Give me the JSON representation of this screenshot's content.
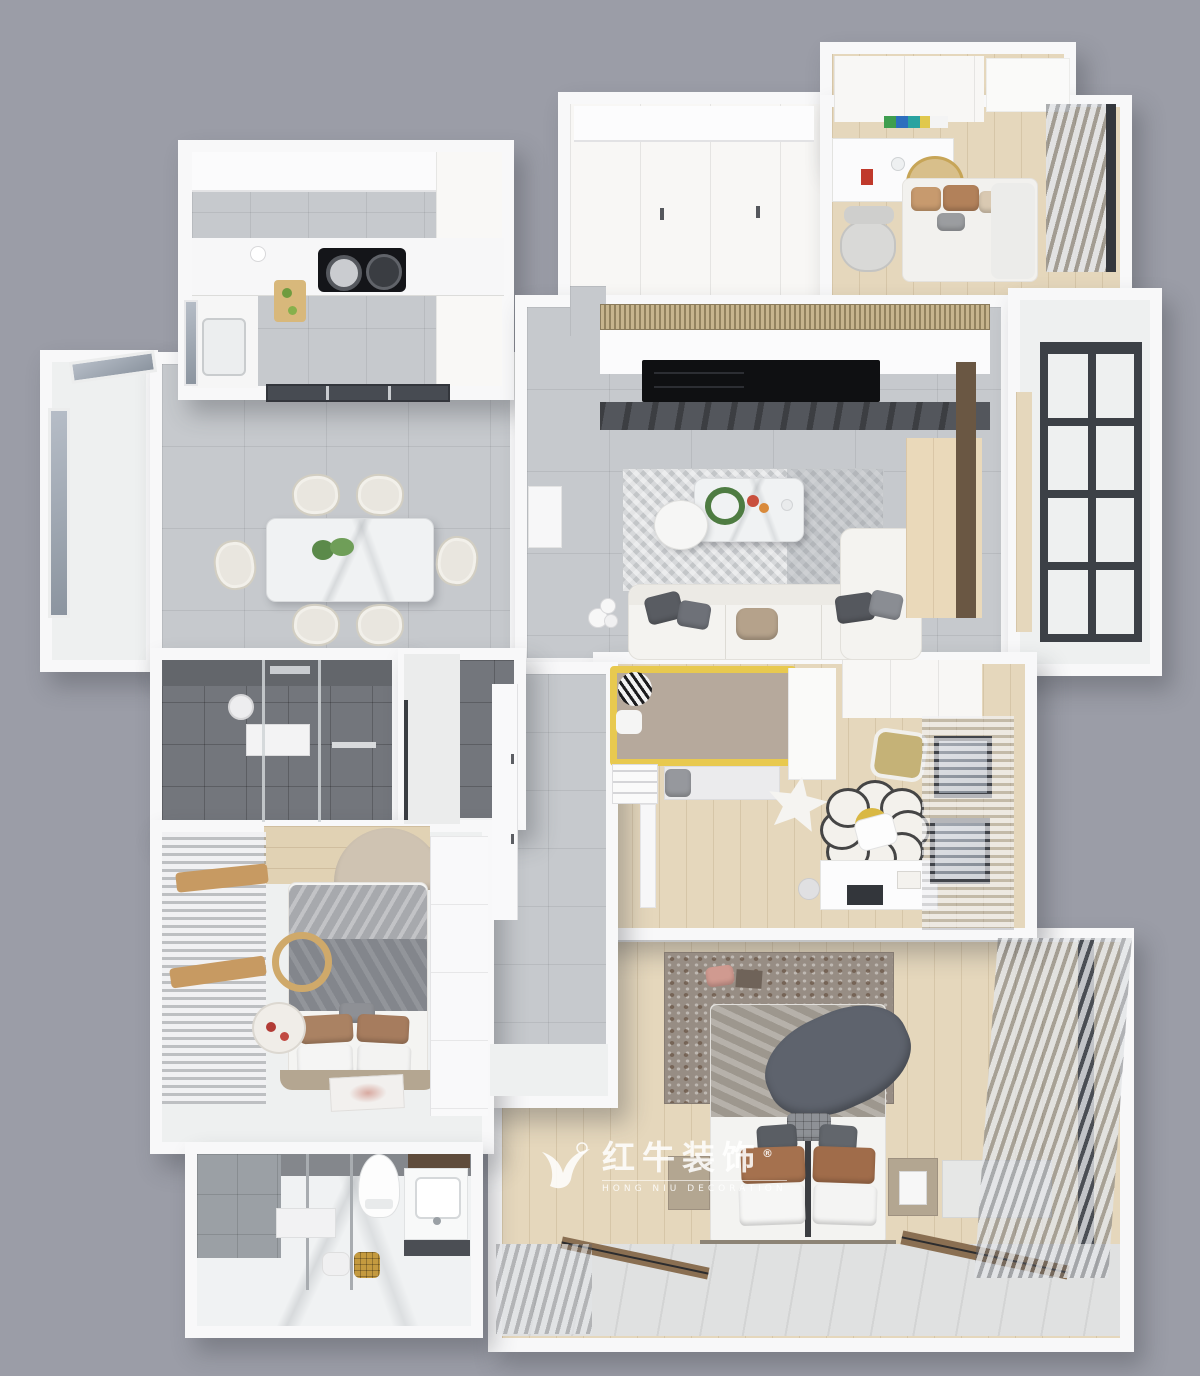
{
  "scene": {
    "description": "3D top-down rendering of an apartment floor plan",
    "background_color": "#9b9da7"
  },
  "watermark": {
    "logo_icon": "hongniu-bull-logo",
    "registered_mark": "®",
    "brand_cn": "红牛装饰",
    "brand_en": "HONG NIU DECORATION",
    "text_color": "#ffffff"
  },
  "palette": {
    "wall_white": "#f8f8f9",
    "floor_tile_gray": "#c6c9cd",
    "floor_tile_dark": "#73767c",
    "floor_wood_light": "#e5d7bc",
    "floor_marble_white": "#f0f2f3",
    "window_frame_dark": "#3c4046",
    "accent_yellow": "#e8c94f",
    "sofa_white": "#f4f3f0",
    "bedding_gray": "#9d978e",
    "pillow_brown": "#a5714e",
    "dining_marble": "#f2f3f4",
    "curtain_gray": "#b9bcc2"
  }
}
